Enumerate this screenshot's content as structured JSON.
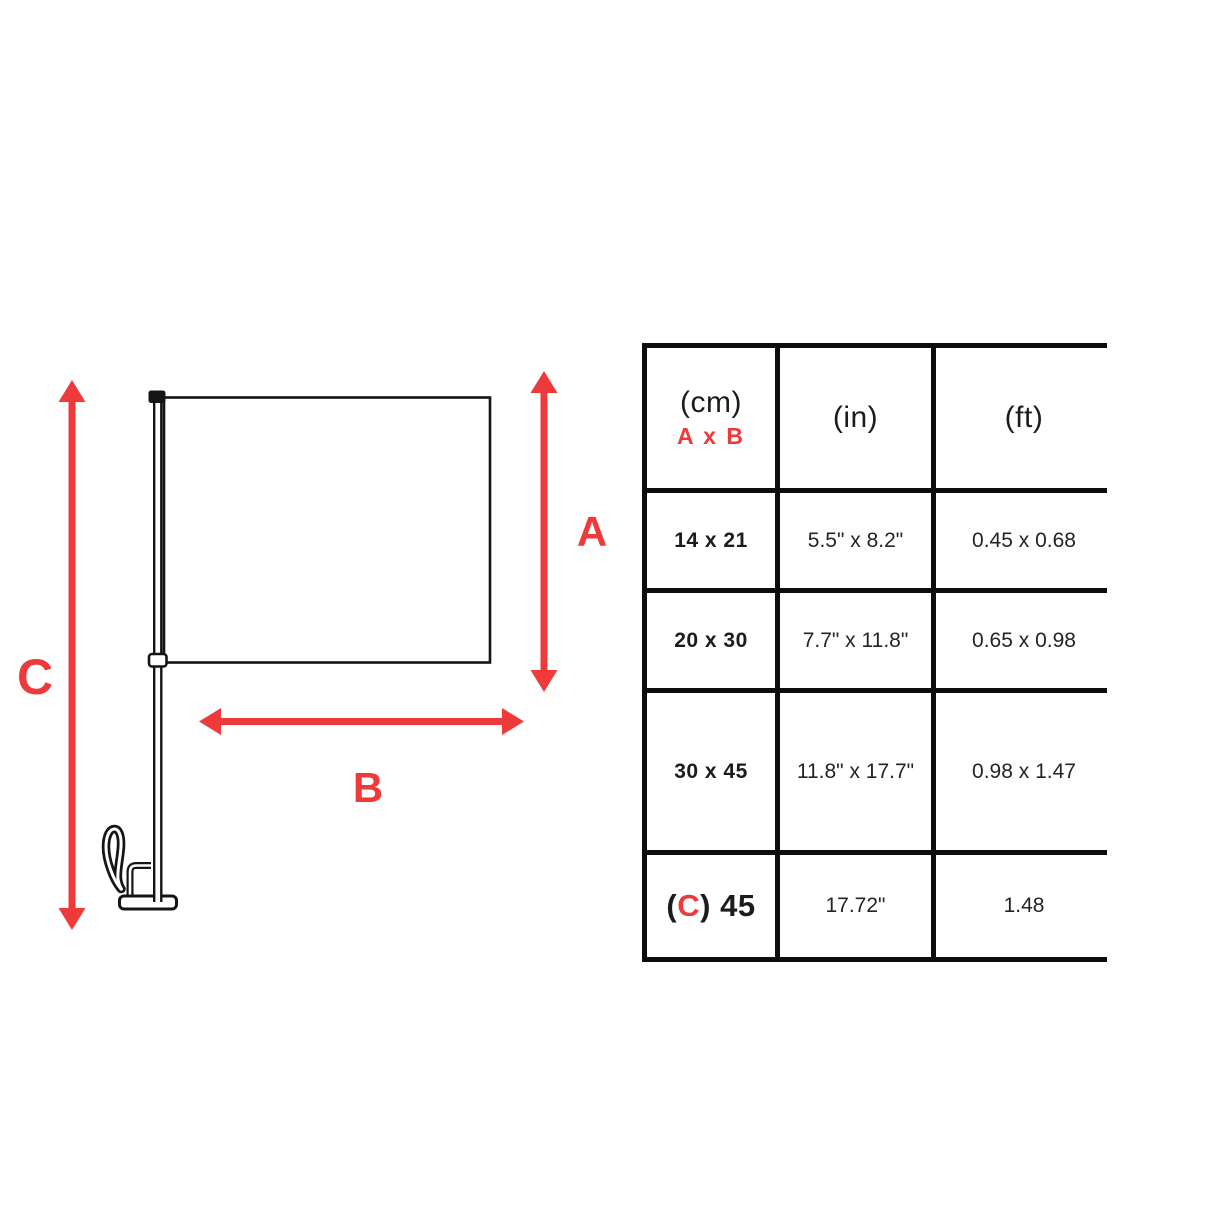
{
  "colors": {
    "accent_red": "#EF3A3C",
    "line_black": "#151515"
  },
  "diagram": {
    "label_a": "A",
    "label_b": "B",
    "label_c": "C"
  },
  "table": {
    "header": {
      "unit_cm": "(cm)",
      "axb": "A x B",
      "unit_in": "(in)",
      "unit_ft": "(ft)"
    },
    "rows": [
      {
        "cm": "14 x 21",
        "inches": "5.5\" x 8.2\"",
        "feet": "0.45 x 0.68"
      },
      {
        "cm": "20 x 30",
        "inches": "7.7\" x 11.8\"",
        "feet": "0.65 x 0.98"
      },
      {
        "cm": "30 x 45",
        "inches": "11.8\" x 17.7\"",
        "feet": "0.98 x 1.47"
      },
      {
        "cm_open": "(",
        "cm_c": "C",
        "cm_rest": ") 45",
        "inches": "17.72\"",
        "feet": "1.48"
      }
    ]
  }
}
